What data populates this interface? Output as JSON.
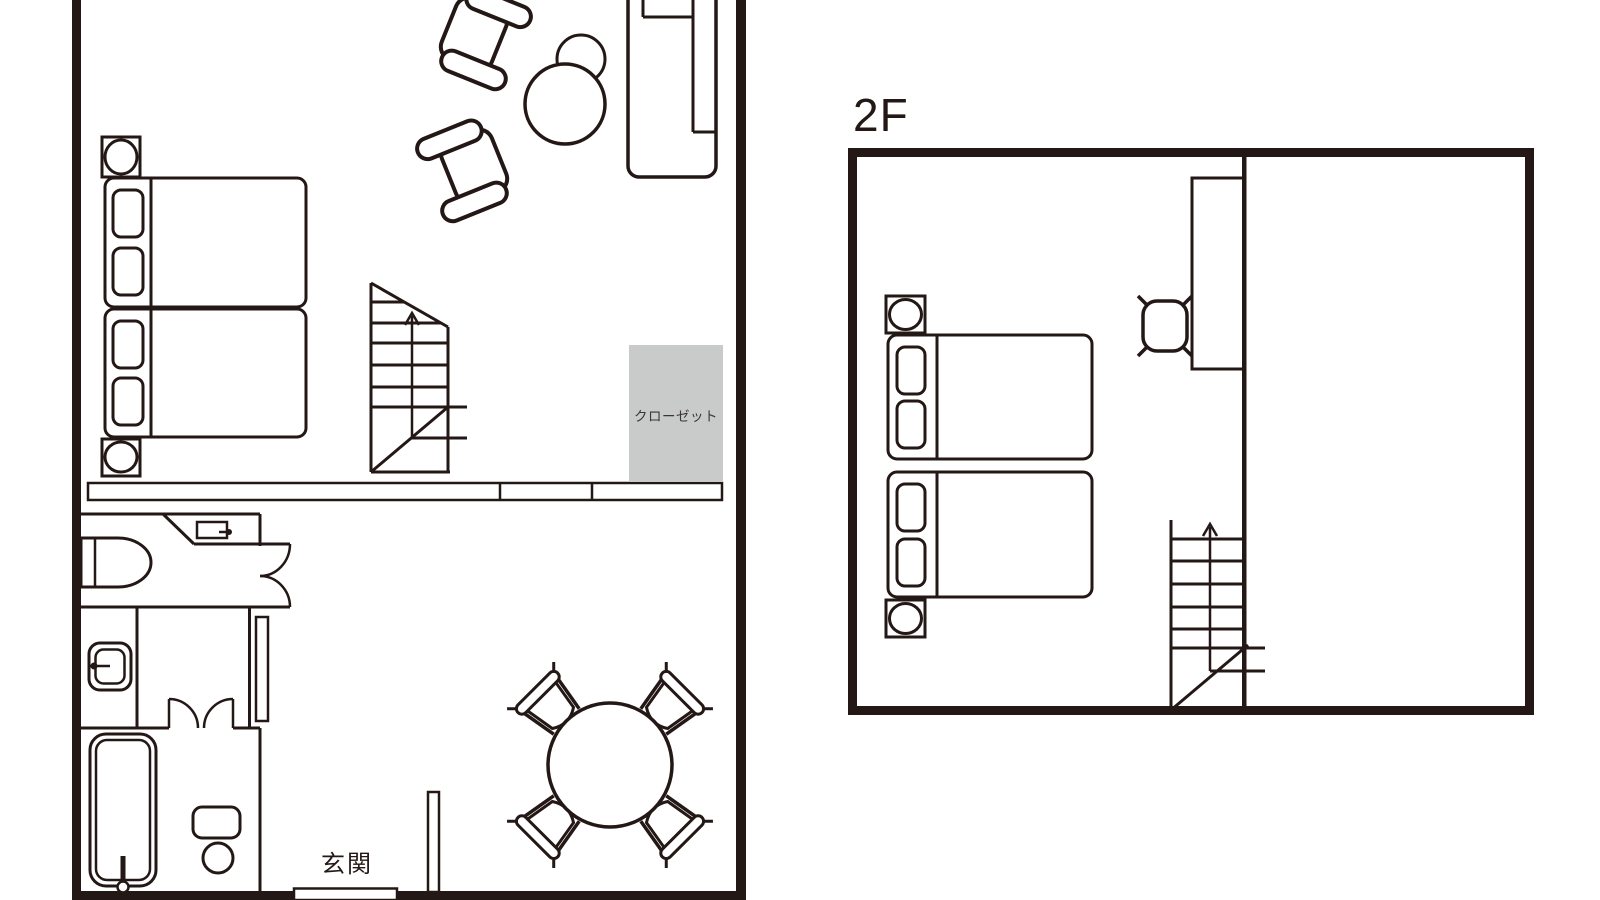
{
  "document": {
    "type": "floor-plan",
    "background": "#ffffff"
  },
  "colors": {
    "line": "#231815",
    "wall": "#231815",
    "closet_fill": "#c9caca",
    "closet_text": "#3a3632",
    "label_text": "#231815"
  },
  "floor1": {
    "labels": {
      "closet": "クローゼット",
      "entrance": "玄関"
    },
    "rooms": [
      "bedroom-living",
      "toilet",
      "washroom",
      "bathroom",
      "entrance-hall"
    ],
    "furniture": [
      "nightstand-with-lamp",
      "single-bed",
      "single-bed",
      "nightstand-with-lamp",
      "armchair",
      "armchair",
      "round-side-table",
      "sofa",
      "staircase-up",
      "long-counter",
      "closet",
      "toilet-bowl",
      "small-sink",
      "corner-partition",
      "double-swing-door",
      "washbasin",
      "sliding-door",
      "double-door",
      "bathtub",
      "bath-stool-set",
      "dining-table-round",
      "dining-chair",
      "dining-chair",
      "dining-chair",
      "dining-chair",
      "entrance-step",
      "partition-stub"
    ]
  },
  "floor2": {
    "label": "2F",
    "rooms": [
      "bedroom",
      "open-room"
    ],
    "furniture": [
      "nightstand-with-lamp",
      "single-bed",
      "single-bed",
      "nightstand-with-lamp",
      "desk",
      "desk-chair",
      "staircase-up",
      "interior-wall"
    ]
  }
}
